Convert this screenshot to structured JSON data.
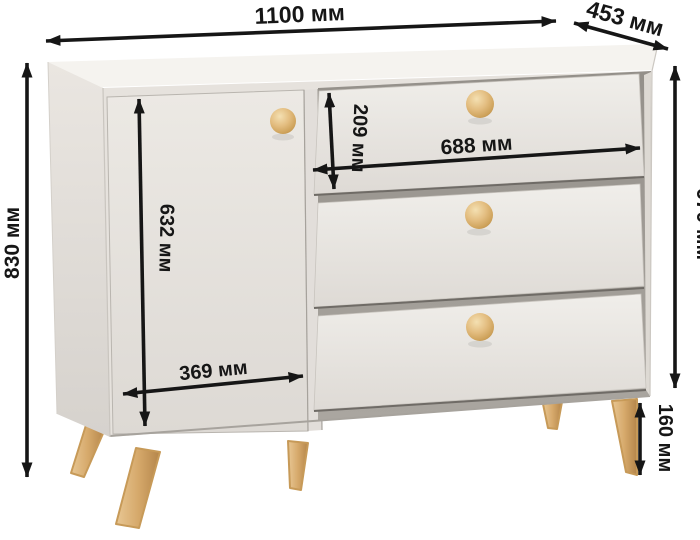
{
  "diagram": {
    "kind": "furniture-dimension-diagram",
    "unit": "мм"
  },
  "dimensions": {
    "overall_width": {
      "value_mm": 1100,
      "label": "1100 мм"
    },
    "depth": {
      "value_mm": 453,
      "label": "453 мм"
    },
    "overall_height": {
      "value_mm": 830,
      "label": "830 мм"
    },
    "body_height": {
      "value_mm": 670,
      "label": "670 мм"
    },
    "top_drawer_height": {
      "value_mm": 209,
      "label": "209 мм"
    },
    "drawer_width": {
      "value_mm": 688,
      "label": "688 мм"
    },
    "door_height": {
      "value_mm": 632,
      "label": "632 мм"
    },
    "door_width": {
      "value_mm": 369,
      "label": "369 мм"
    },
    "leg_height": {
      "value_mm": 160,
      "label": "160 мм"
    }
  },
  "colors": {
    "background": "#ffffff",
    "dimension_ink": "#161616",
    "top_face": "#f5f3ef",
    "front_face": "#e6e2dd",
    "door_face": "#eae7e2",
    "drawer_face": "#edebe7",
    "side_panel_dark": "#d6d2cd",
    "recess_shadow": "#a29d97",
    "wood_light": "#e8c794",
    "wood_mid": "#d6a96b",
    "wood_dark": "#b98a4c"
  }
}
